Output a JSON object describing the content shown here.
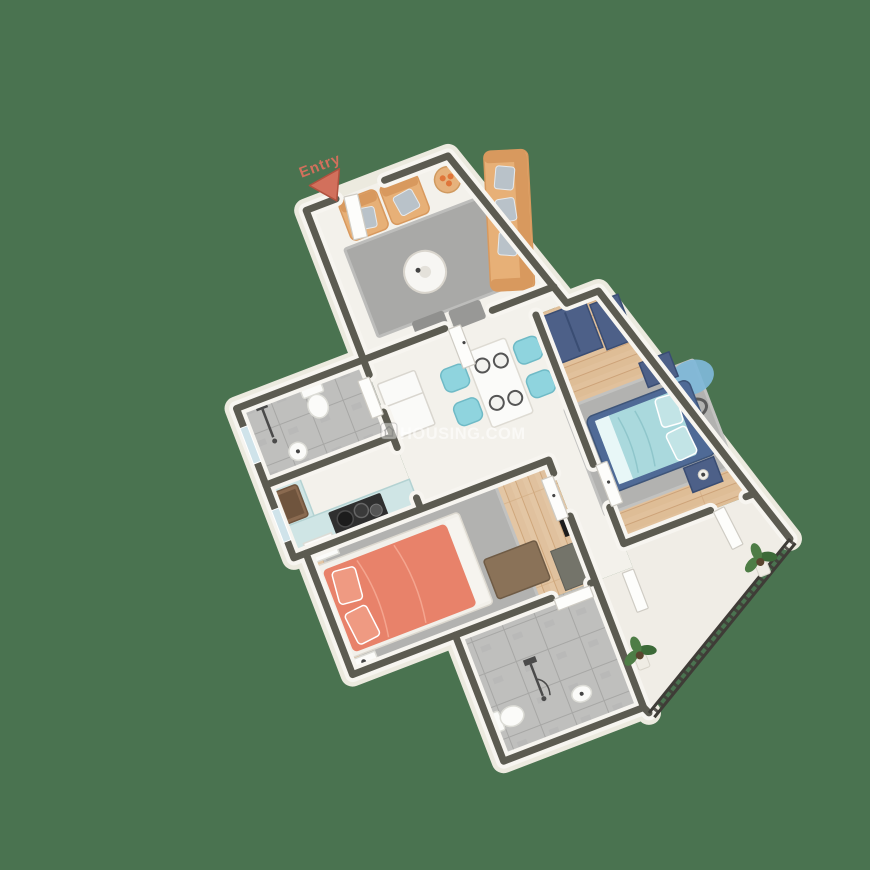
{
  "entry": {
    "label": "Entry"
  },
  "watermark": {
    "text": "HOUSING.COM"
  },
  "colors": {
    "bg": "#4a7350",
    "wall_cap": "#5c5b51",
    "wall_face": "#f7f5f0",
    "apron": "#eceadf",
    "marble": "#f3f1eb",
    "balcony": "#f0ede6",
    "rug": "#a9a9a7",
    "rug2": "#b2b2b0",
    "sofa": "#e7b077",
    "sofa_dark": "#d8995e",
    "pillow_gray": "#b9c2c9",
    "table_white": "#fbfbf9",
    "chair_teal": "#8fd4de",
    "counter": "#cfe5e5",
    "fridge": "#fafaf8",
    "stove": "#2f2f2f",
    "sink_brown": "#8a6a50",
    "wardrobe_navy": "#4d6088",
    "bed_frame_navy": "#4f6a96",
    "bedding_cyan": "#aad9dd",
    "pillow_cyan": "#c2e4e6",
    "bed_orange": "#e8826a",
    "pillow_orange": "#ef9a82",
    "bench_brown": "#8a7258",
    "console": "#74746a",
    "tv_black": "#1d1d1d",
    "railing": "#3f3c37",
    "plant_green": "#4e7d46",
    "window_blue": "#cfe3ea",
    "entry_red": "#d2705c",
    "wood_master": "#e1c19c",
    "wood_bedroom2": "#e3c6a4",
    "tile_gray": "#bfbfbd"
  }
}
